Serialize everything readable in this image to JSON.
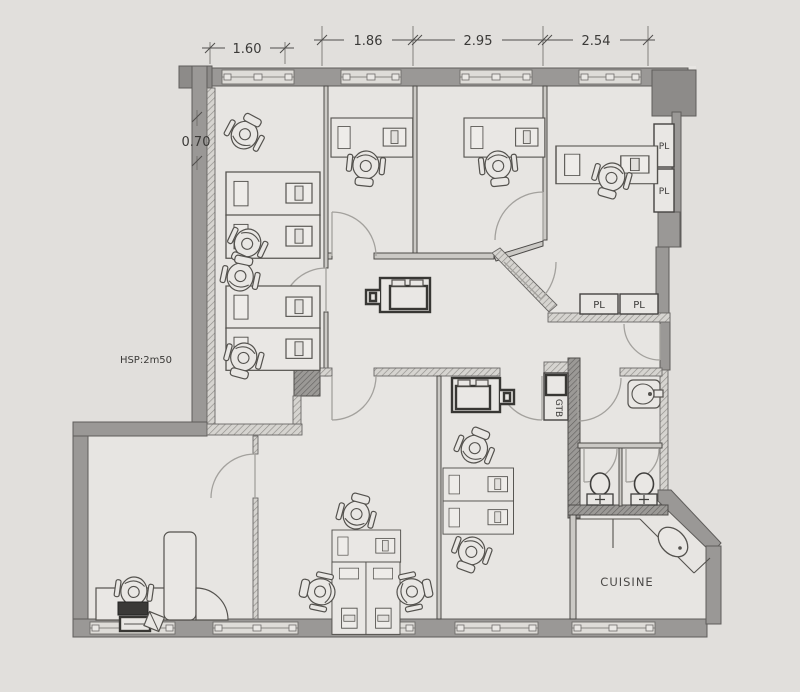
{
  "title": "office-floor-plan",
  "dimensions": {
    "top_width_1": "1.60",
    "top_width_2": "1.86",
    "top_width_3": "2.95",
    "top_width_4": "2.54",
    "left_height": "0.70"
  },
  "notes": {
    "ceiling_height": "HSP:2m50"
  },
  "rooms": {
    "kitchen_label": "CUISINE"
  },
  "closets": {
    "right_upper": "PL",
    "right_lower": "PL",
    "mid_left": "PL",
    "mid_right": "PL"
  },
  "utility": {
    "duct_label": "GTB"
  },
  "colors": {
    "page_background": "#e1dfdc",
    "floor": "#e7e5e2",
    "wall_gray": "#9a9896",
    "wall_dark": "#8d8b89",
    "line_dark": "#3b3a38",
    "door_arc": "#a3a19d"
  }
}
